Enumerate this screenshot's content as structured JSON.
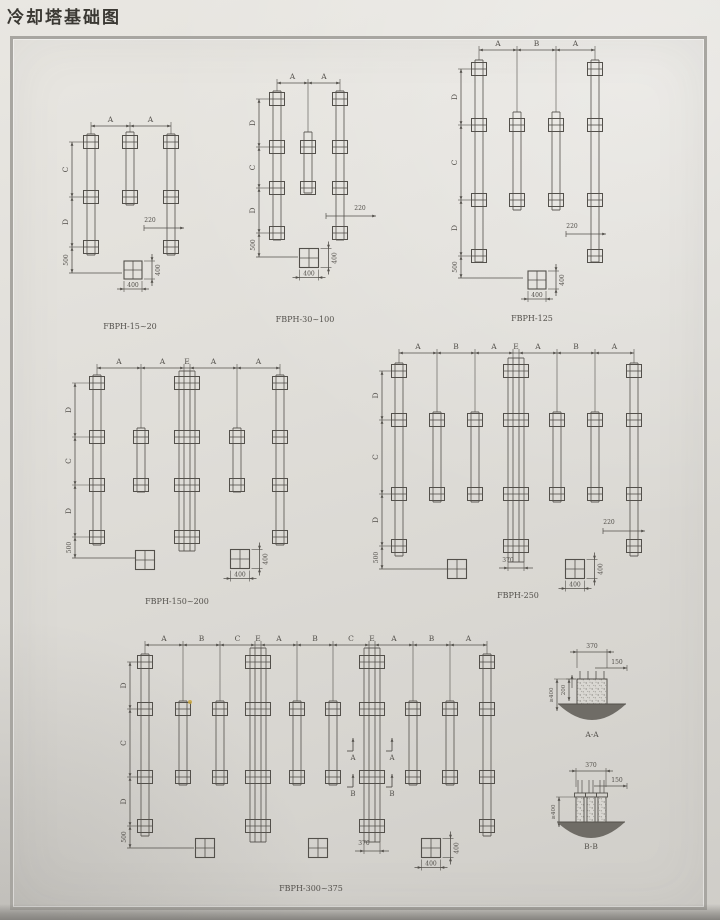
{
  "title": "冷却塔基础图",
  "ink": "#53504b",
  "ground_color": "#6f6c66",
  "plans": [
    {
      "label": "FBPH-15~20",
      "x": 58,
      "y": 100,
      "w": 142,
      "h": 236,
      "top_y": 26,
      "top_labels": [
        "A",
        "A"
      ],
      "left_x": 14,
      "left_labels": [
        "C",
        "D"
      ],
      "left_bottom": "500",
      "rows": [
        42,
        97,
        147
      ],
      "short_rows": [
        0,
        1
      ],
      "cols": [
        {
          "x": 33,
          "t": "long"
        },
        {
          "x": 72,
          "t": "short"
        },
        {
          "x": 113,
          "t": "long"
        }
      ],
      "long_top": 34,
      "long_bot": 155,
      "short_top": 32,
      "short_bot": 105,
      "bottom_y": 173,
      "bottom_x2": 64,
      "dim220": {
        "label": "220",
        "lx": 92,
        "ly": 122,
        "x1": 86,
        "x2": 126,
        "yy": 128
      },
      "detail": {
        "cx": 75,
        "cy": 170,
        "s": 18,
        "wl": "400",
        "hl": "400"
      },
      "lx": 72,
      "ly": 229
    },
    {
      "label": "FBPH-30~100",
      "x": 238,
      "y": 58,
      "w": 148,
      "h": 272,
      "top_y": 25,
      "top_labels": [
        "A",
        "A"
      ],
      "left_x": 21,
      "left_labels": [
        "D",
        "C",
        "D"
      ],
      "left_bottom": "500",
      "rows": [
        41,
        89,
        130,
        175
      ],
      "short_rows": [
        1,
        2
      ],
      "cols": [
        {
          "x": 39,
          "t": "long"
        },
        {
          "x": 70,
          "t": "short"
        },
        {
          "x": 102,
          "t": "long"
        }
      ],
      "long_top": 33,
      "long_bot": 182,
      "short_top": 74,
      "short_bot": 135,
      "bottom_y": 199,
      "bottom_x2": 60,
      "dim220": {
        "label": "220",
        "lx": 122,
        "ly": 152,
        "x1": 88,
        "x2": 138,
        "yy": 158
      },
      "detail": {
        "cx": 71,
        "cy": 200,
        "s": 19,
        "wl": "400",
        "hl": "400"
      },
      "lx": 67,
      "ly": 264
    },
    {
      "label": "FBPH-125",
      "x": 428,
      "y": 28,
      "w": 208,
      "h": 302,
      "top_y": 22,
      "top_labels": [
        "A",
        "B",
        "A"
      ],
      "left_x": 33,
      "left_labels": [
        "D",
        "C",
        "D"
      ],
      "left_bottom": "500",
      "rows": [
        41,
        97,
        172,
        228
      ],
      "short_rows": [
        1,
        2
      ],
      "cols": [
        {
          "x": 51,
          "t": "long"
        },
        {
          "x": 89,
          "t": "short"
        },
        {
          "x": 128,
          "t": "short"
        },
        {
          "x": 167,
          "t": "long"
        }
      ],
      "long_top": 32,
      "long_bot": 234,
      "short_top": 84,
      "short_bot": 182,
      "bottom_y": 250,
      "bottom_x2": 95,
      "dim220": {
        "label": "220",
        "lx": 144,
        "ly": 200,
        "x1": 138,
        "x2": 178,
        "yy": 206
      },
      "detail": {
        "cx": 109,
        "cy": 252,
        "s": 18,
        "wl": "400",
        "hl": "400"
      },
      "lx": 104,
      "ly": 293
    },
    {
      "label": "FBPH-150~200",
      "x": 58,
      "y": 338,
      "w": 252,
      "h": 276,
      "top_y": 30,
      "top_labels": [
        "A",
        "A",
        "E",
        "A",
        "A"
      ],
      "left_x": 17,
      "left_labels": [
        "D",
        "C",
        "D"
      ],
      "left_bottom": "500",
      "rows": [
        45,
        99,
        147,
        199
      ],
      "short_rows": [
        1,
        2
      ],
      "cols": [
        {
          "x": 39,
          "t": "long"
        },
        {
          "x": 83,
          "t": "short"
        },
        {
          "x": 129,
          "t": "wide"
        },
        {
          "x": 179,
          "t": "short"
        },
        {
          "x": 222,
          "t": "long"
        }
      ],
      "long_top": 37,
      "long_bot": 207,
      "short_top": 90,
      "short_bot": 154,
      "wide_top": 33,
      "wide_bot": 213,
      "bottom_y": 220,
      "bottom_x2": 78,
      "plain": [
        {
          "cx": 87,
          "cy": 222
        }
      ],
      "detail": {
        "cx": 182,
        "cy": 221,
        "s": 19,
        "wl": "400",
        "hl": "400"
      },
      "lx": 119,
      "ly": 266
    },
    {
      "label": "FBPH-250",
      "x": 358,
      "y": 328,
      "w": 304,
      "h": 292,
      "top_y": 25,
      "top_labels": [
        "A",
        "B",
        "A",
        "E",
        "A",
        "B",
        "A"
      ],
      "left_x": 24,
      "left_labels": [
        "D",
        "C",
        "D"
      ],
      "left_bottom": "500",
      "rows": [
        43,
        92,
        166,
        218
      ],
      "short_rows": [
        1,
        2
      ],
      "cols": [
        {
          "x": 41,
          "t": "long"
        },
        {
          "x": 79,
          "t": "short"
        },
        {
          "x": 117,
          "t": "short"
        },
        {
          "x": 158,
          "t": "wide"
        },
        {
          "x": 199,
          "t": "short"
        },
        {
          "x": 237,
          "t": "short"
        },
        {
          "x": 276,
          "t": "long"
        }
      ],
      "long_top": 35,
      "long_bot": 228,
      "short_top": 84,
      "short_bot": 174,
      "wide_top": 30,
      "wide_bot": 234,
      "dim370": {
        "label": "370",
        "col": 3,
        "lx": 150,
        "ly": 234,
        "yy": 240
      },
      "bottom_y": 241,
      "bottom_x2": 89,
      "plain": [
        {
          "cx": 99,
          "cy": 241
        }
      ],
      "dim220": {
        "label": "220",
        "lx": 251,
        "ly": 196,
        "x1": 245,
        "x2": 287,
        "yy": 203
      },
      "detail": {
        "cx": 217,
        "cy": 241,
        "s": 19,
        "wl": "400",
        "hl": "400"
      },
      "lx": 160,
      "ly": 270
    },
    {
      "label": "FBPH-300~375",
      "x": 108,
      "y": 618,
      "w": 407,
      "h": 296,
      "top_y": 27,
      "top_labels": [
        "A",
        "B",
        "C",
        "E",
        "A",
        "B",
        "C",
        "E",
        "A",
        "B",
        "A"
      ],
      "left_x": 22,
      "left_labels": [
        "D",
        "C",
        "D"
      ],
      "left_bottom": "500",
      "rows": [
        44,
        91,
        159,
        208
      ],
      "short_rows": [
        1,
        2
      ],
      "cols": [
        {
          "x": 37,
          "t": "long"
        },
        {
          "x": 75,
          "t": "short"
        },
        {
          "x": 112,
          "t": "short"
        },
        {
          "x": 150,
          "t": "wide"
        },
        {
          "x": 189,
          "t": "short"
        },
        {
          "x": 225,
          "t": "short"
        },
        {
          "x": 264,
          "t": "wide"
        },
        {
          "x": 305,
          "t": "short"
        },
        {
          "x": 342,
          "t": "short"
        },
        {
          "x": 379,
          "t": "long"
        }
      ],
      "long_top": 36,
      "long_bot": 218,
      "short_top": 83,
      "short_bot": 167,
      "wide_top": 30,
      "wide_bot": 224,
      "dim370": {
        "label": "370",
        "col": 6,
        "lx": 256,
        "ly": 227,
        "yy": 233
      },
      "bottom_y": 230,
      "bottom_x2": 86,
      "plain": [
        {
          "cx": 97,
          "cy": 230
        },
        {
          "cx": 210,
          "cy": 230
        }
      ],
      "marks": [
        {
          "x": 245,
          "y": 133,
          "f": -1,
          "label": "A"
        },
        {
          "x": 284,
          "y": 133,
          "f": -1,
          "label": "A"
        },
        {
          "x": 245,
          "y": 169,
          "f": -1,
          "label": "B"
        },
        {
          "x": 284,
          "y": 169,
          "f": -1,
          "label": "B"
        }
      ],
      "detail": {
        "cx": 323,
        "cy": 230,
        "s": 19,
        "wl": "400",
        "hl": "400"
      },
      "lx": 203,
      "ly": 273
    }
  ],
  "sections": [
    {
      "label": "A-A",
      "x": 543,
      "y": 633,
      "w": 117,
      "h": 119,
      "type": "block",
      "bx1": 34,
      "bx2": 64,
      "by1": 46,
      "by2": 71,
      "bolts": [
        37,
        45,
        53,
        61
      ],
      "bolt_top": 38,
      "top": {
        "label": "370",
        "yy": 19,
        "ly": 15
      },
      "right": {
        "label": "150",
        "lx": 74,
        "ly": 31,
        "yy": 35,
        "x2": 84
      },
      "lefts": [
        {
          "label": "≥400",
          "x": 14,
          "y1": 46,
          "y2": 78
        },
        {
          "label": "200",
          "x": 26,
          "y1": 46,
          "y2": 68
        }
      ],
      "ground": {
        "x1": 15,
        "x2": 83,
        "y": 71,
        "d": 16
      },
      "lx": 49,
      "ly": 104
    },
    {
      "label": "B-B",
      "x": 543,
      "y": 758,
      "w": 117,
      "h": 108,
      "type": "piers",
      "piers": [
        [
          33,
          41
        ],
        [
          44,
          52
        ],
        [
          55,
          63
        ]
      ],
      "py1": 39,
      "py2": 64,
      "bolt_top": 22,
      "top": {
        "label": "370",
        "yy": 13,
        "ly": 9
      },
      "right": {
        "label": "150",
        "lx": 74,
        "ly": 24,
        "yy": 28,
        "x2": 84
      },
      "lefts": [
        {
          "label": "≥400",
          "x": 16,
          "y1": 39,
          "y2": 69
        }
      ],
      "ground": {
        "x1": 14,
        "x2": 82,
        "y": 64,
        "d": 16
      },
      "lx": 48,
      "ly": 91
    }
  ]
}
